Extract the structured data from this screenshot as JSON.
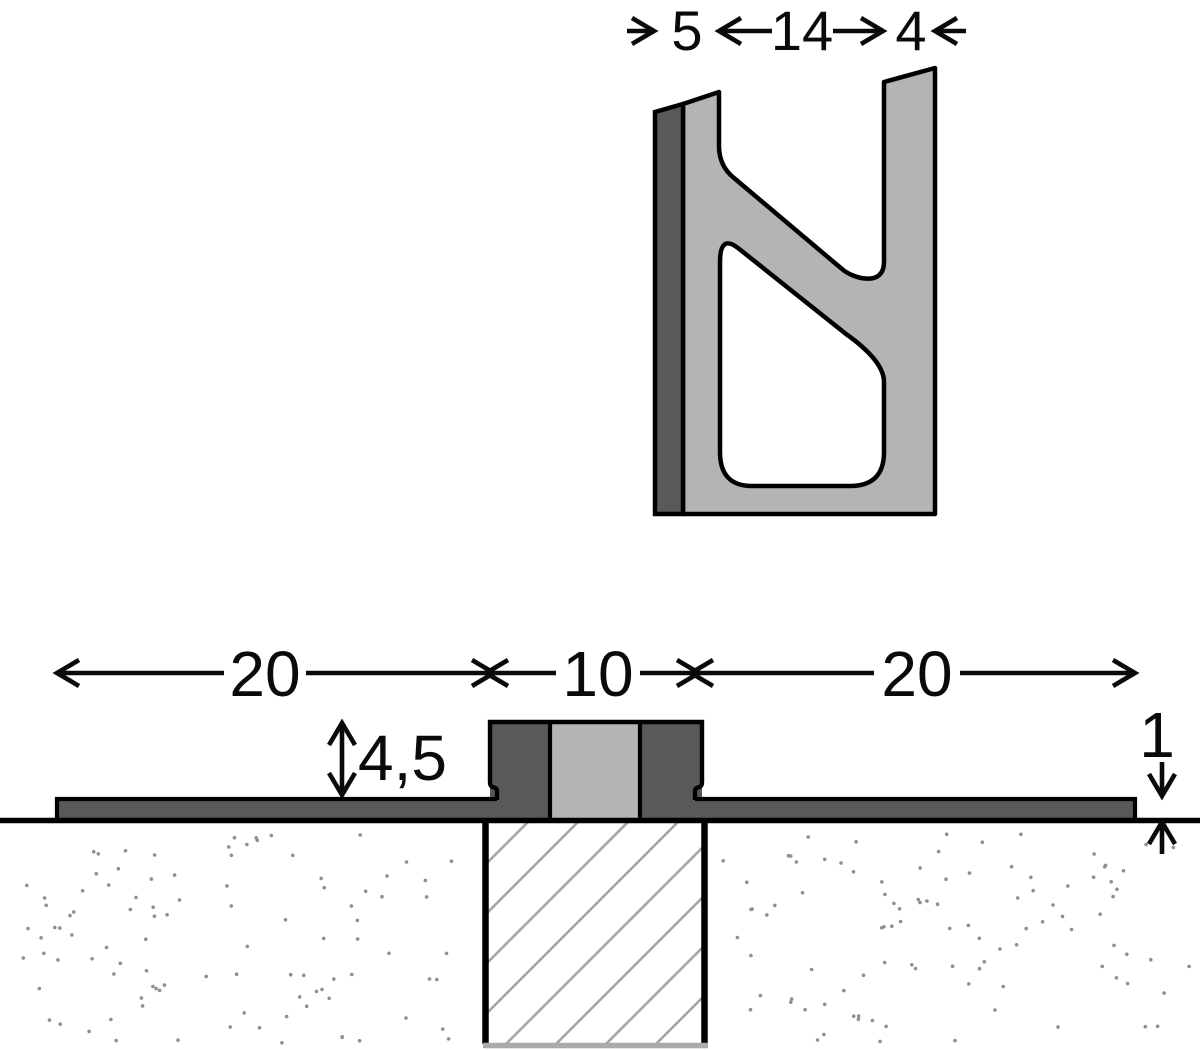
{
  "diagram": {
    "colors": {
      "outline": "#000000",
      "profile_dark": "#58595b",
      "profile_light": "#b3b4b3",
      "hatch_line": "#a6a6a6",
      "substrate_dot": "#8f8f8f",
      "joint_bottom_line": "#ababab",
      "background": "#ffffff"
    },
    "profile_section": {
      "dim_left": "5",
      "dim_middle": "14",
      "dim_right": "4"
    },
    "installed_section": {
      "dim_left_flange": "20",
      "dim_joint_width": "10",
      "dim_right_flange": "20",
      "dim_profile_height": "4,5",
      "dim_flange_thickness": "1"
    }
  }
}
